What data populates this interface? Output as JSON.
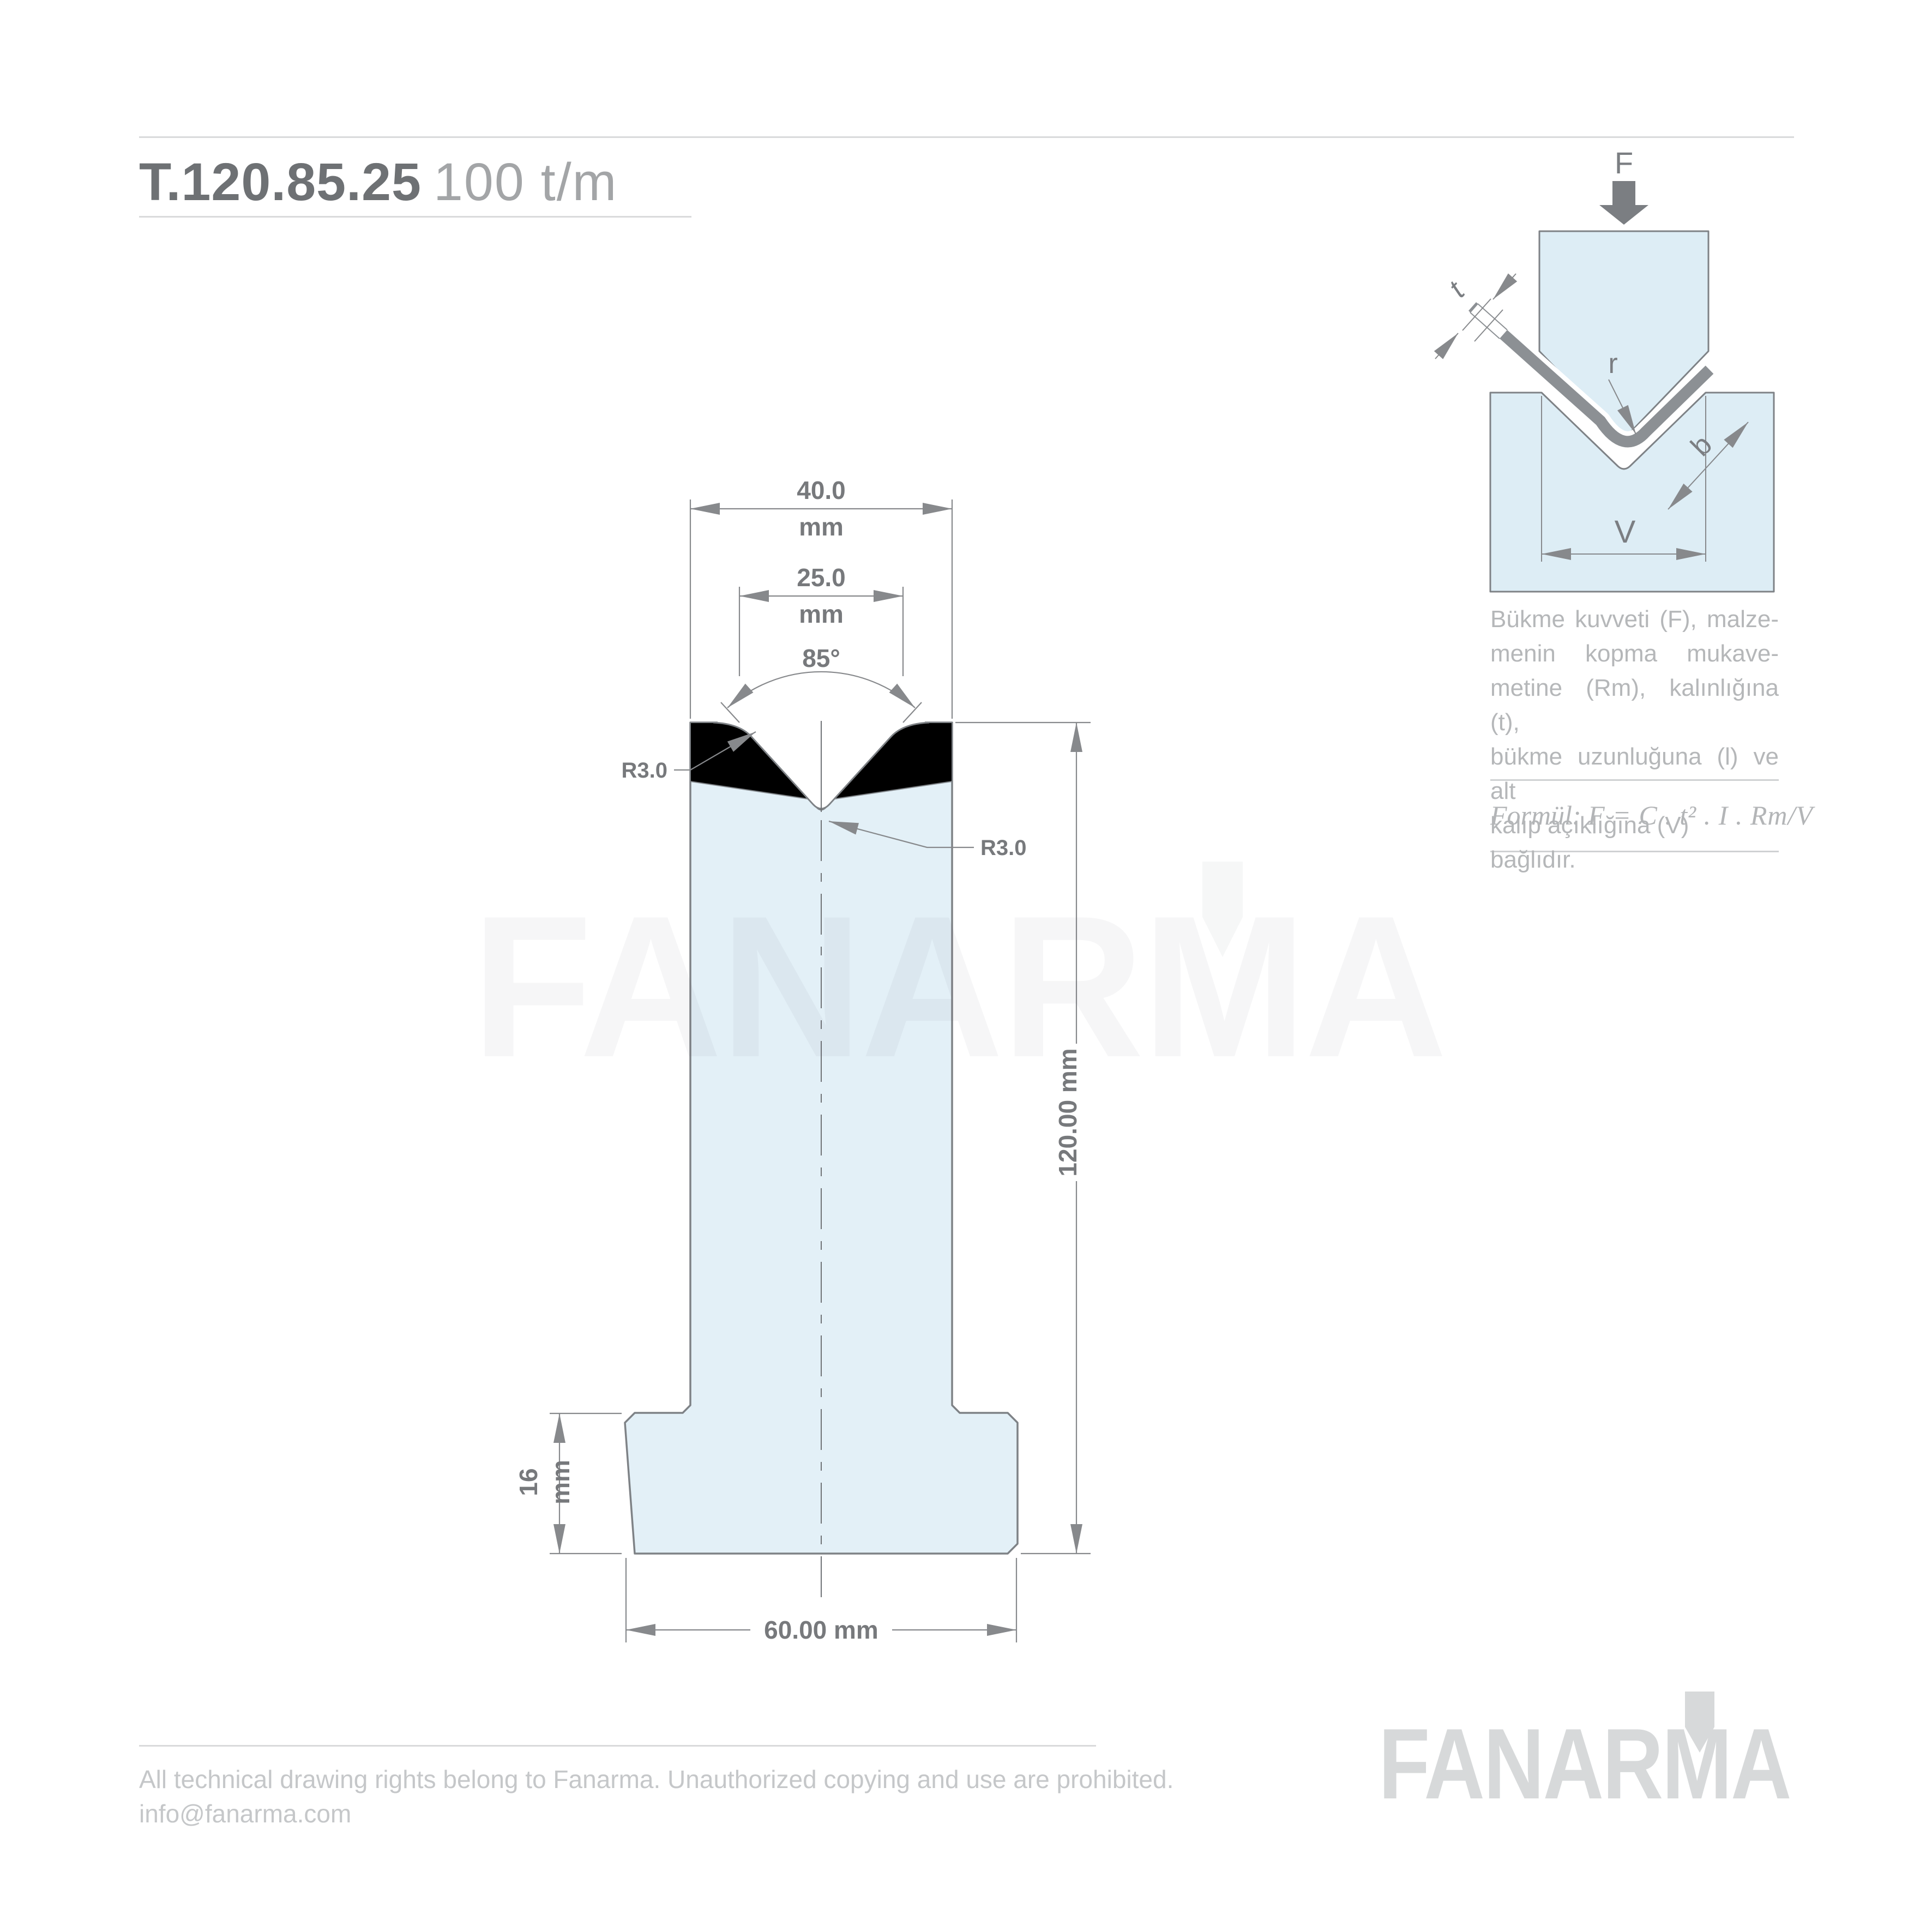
{
  "title": {
    "model": "T.120.85.25",
    "capacity": "100 t/m"
  },
  "main": {
    "dim_top": {
      "value": "40.0",
      "unit": "mm"
    },
    "dim_vee": {
      "value": "25.0",
      "unit": "mm"
    },
    "angle": "85°",
    "radius_left": "R3.0",
    "radius_right": "R3.0",
    "dim_height": "120.00 mm",
    "dim_base_h": {
      "value": "16",
      "unit": "mm"
    },
    "dim_base_w": "60.00 mm"
  },
  "inset": {
    "force": "F",
    "thickness": "t",
    "radius": "r",
    "flank": "b",
    "vee": "V"
  },
  "description": {
    "lines": [
      "Bükme kuvveti (F), malze-",
      "menin kopma mukave-",
      "metine (Rm), kalınlığına (t),",
      "bükme uzunluğuna (l) ve alt",
      "kalıp açıklığına (V) bağlıdır."
    ]
  },
  "formula": {
    "prefix": "Formül:",
    "expression": "F = C . t² . I . Rm/V"
  },
  "watermark": {
    "text": "FANARMA"
  },
  "footer": {
    "copyright": "All technical drawing rights belong to Fanarma. Unauthorized copying and use are prohibited.",
    "email": "info@fanarma.com",
    "logo_text": "FANARMA",
    "logo_mark": "punch-icon"
  },
  "colors": {
    "body_fill": "#e3f0f7",
    "insert_black": "#000000",
    "outline": "#7e8286",
    "dimension": "#87898c",
    "sheet": "#8c9094"
  }
}
